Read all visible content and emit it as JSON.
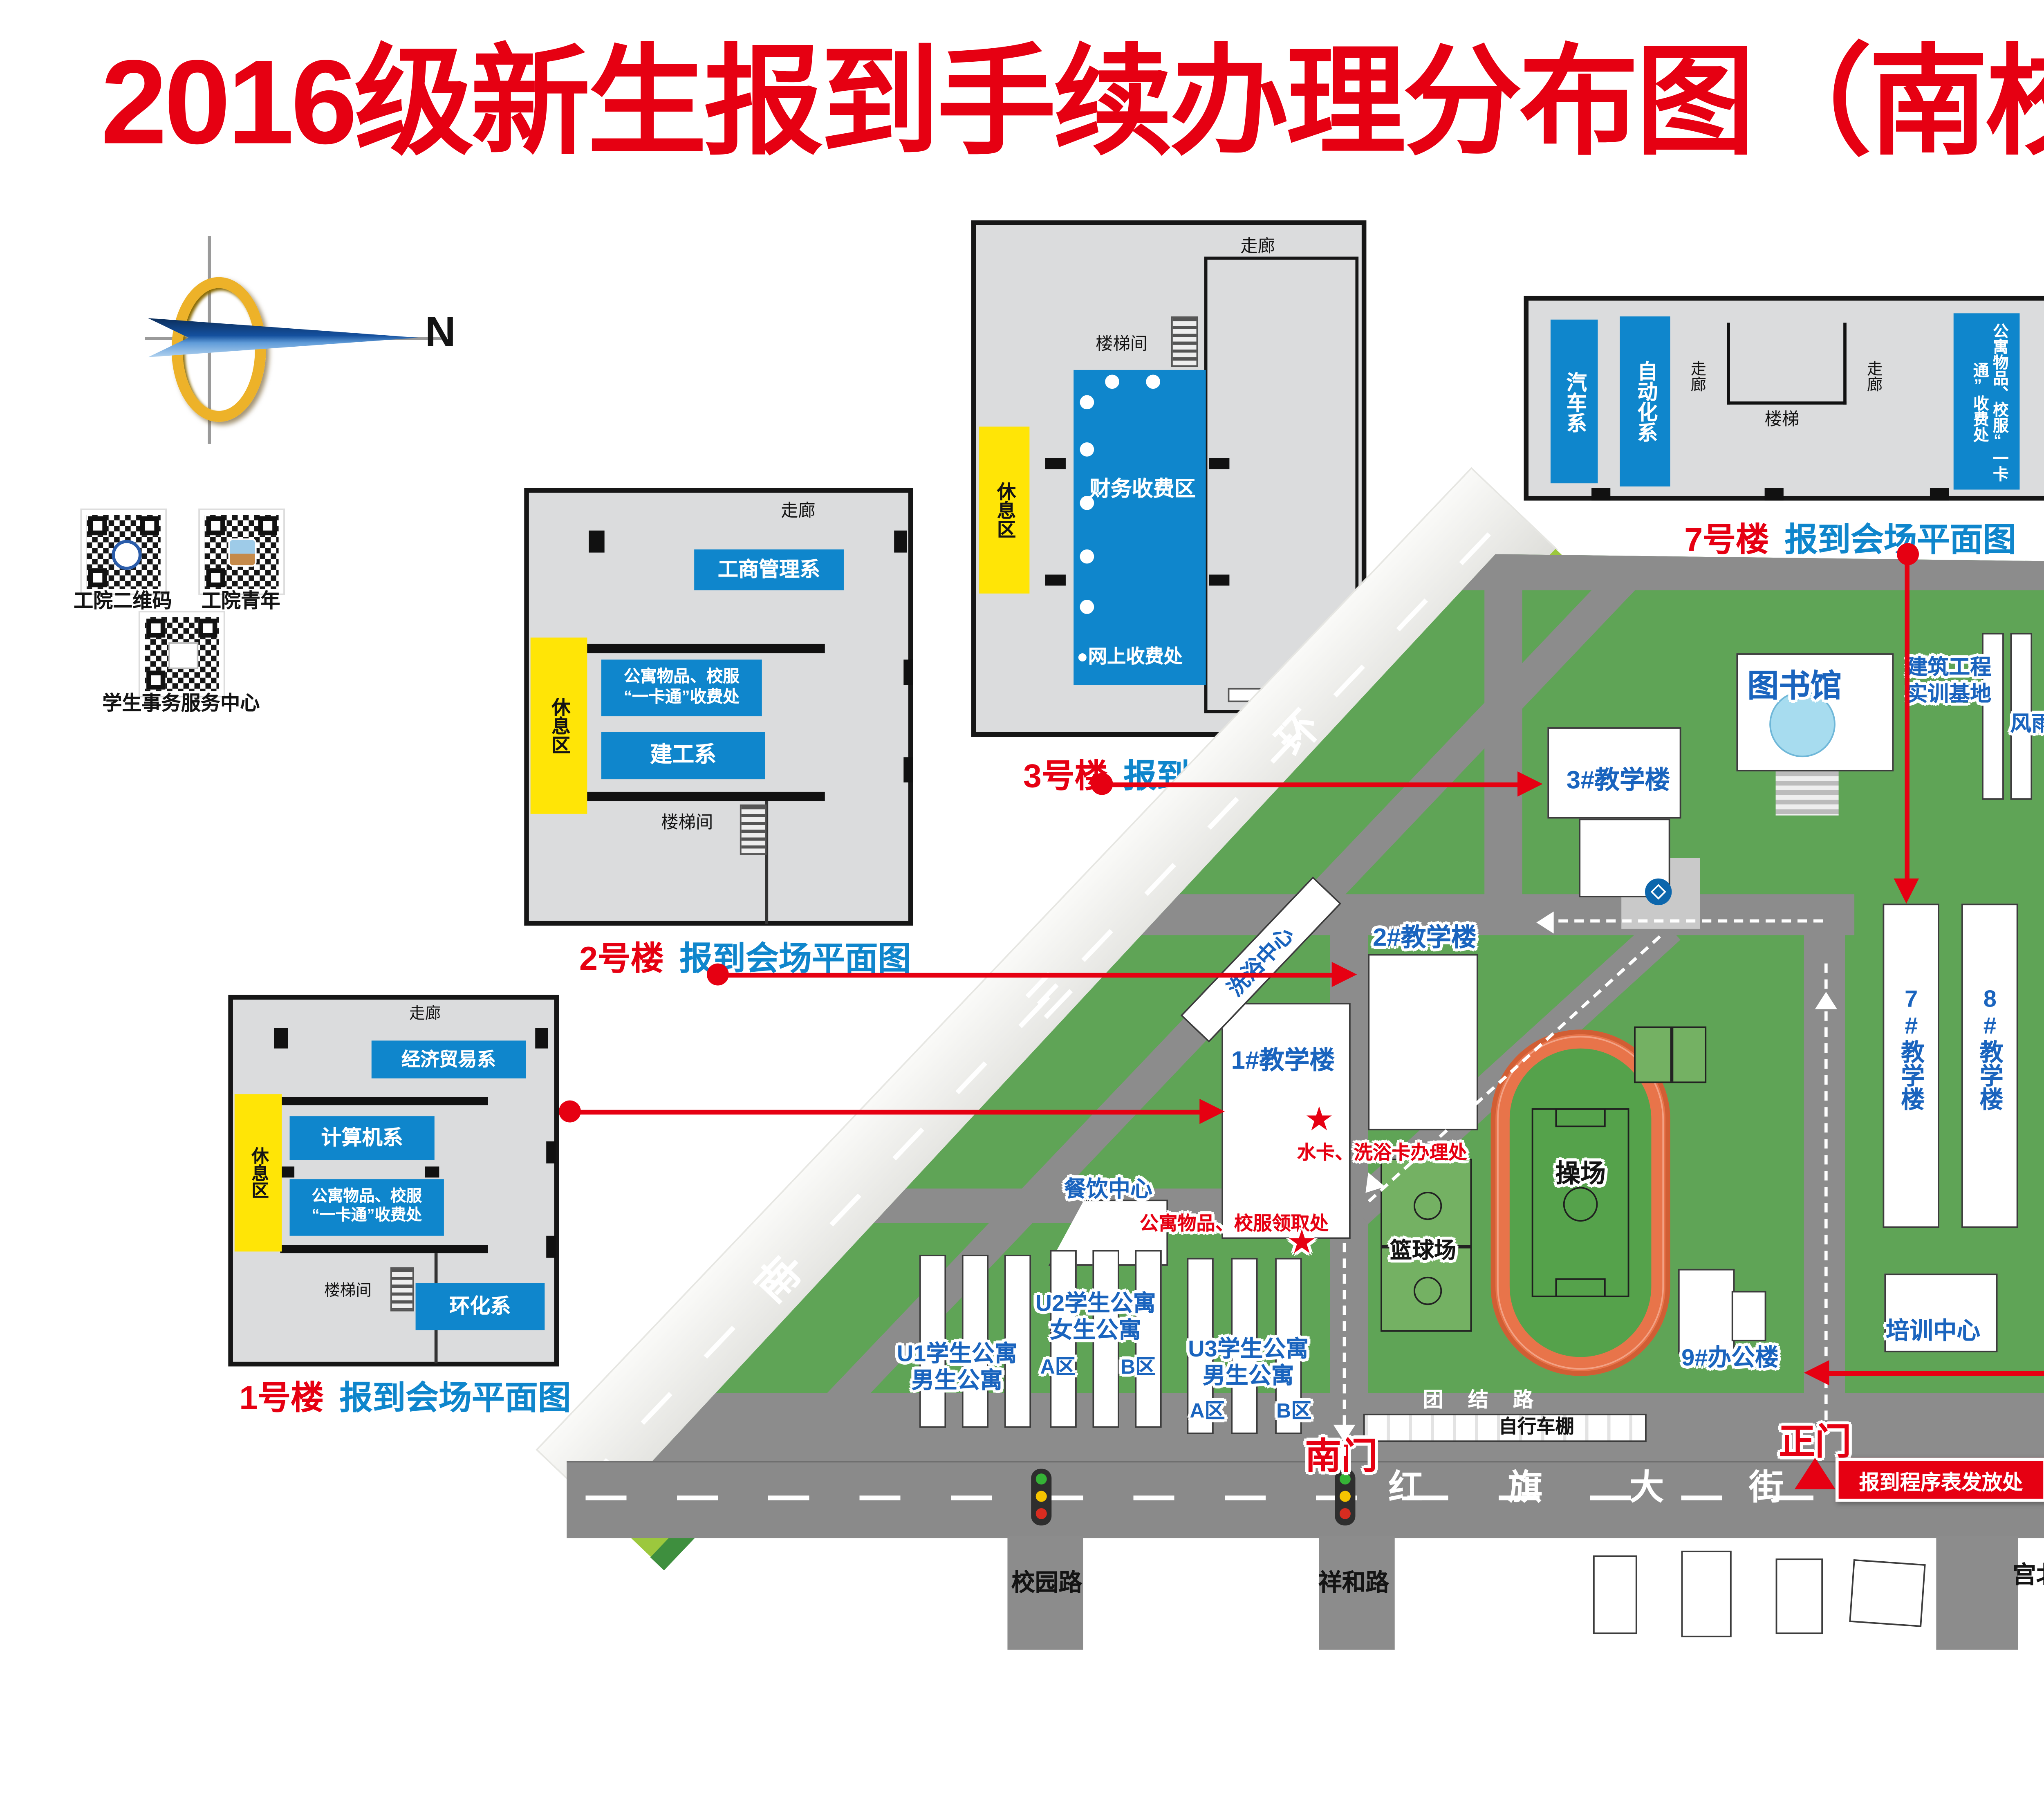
{
  "title": "2016级新生报到手续办理分布图（南校区）",
  "compass": {
    "north": "N"
  },
  "qr": {
    "q1": "工院二维码",
    "q2": "工院青年",
    "q3": "学生事务服务中心"
  },
  "plans": {
    "common": {
      "corridor": "走廊",
      "stair_room": "楼梯间",
      "stair": "楼梯",
      "rest": "休息区",
      "caption": "报到会场平面图"
    },
    "b1": {
      "no": "1号楼",
      "r1": "经济贸易系",
      "r2": "计算机系",
      "r3a": "公寓物品、校服",
      "r3b": "“一卡通”收费处",
      "r4": "环化系"
    },
    "b2": {
      "no": "2号楼",
      "r1": "工商管理系",
      "r2a": "公寓物品、校服",
      "r2b": "“一卡通”收费处",
      "r3": "建工系"
    },
    "b3": {
      "no": "3号楼",
      "r1": "财务收费区",
      "r2": "●网上收费处"
    },
    "b7": {
      "no": "7号楼",
      "r1": "汽车系",
      "r2": "自动化系",
      "r3": "公寓物品、校服“一卡通”收费处",
      "r4": "材料系"
    }
  },
  "map": {
    "ring": {
      "c1": "南",
      "c2": "三",
      "c3": "环"
    },
    "street": {
      "c1": "红",
      "c2": "旗",
      "c3": "大",
      "c4": "街"
    },
    "roads": {
      "tuanjie": "团 结 路",
      "xiaoyuan": "校园路",
      "xianghe": "祥和路",
      "gongbei": "宫北路"
    },
    "gates": {
      "south": "南门",
      "main": "正门"
    },
    "bld": {
      "library": "图书馆",
      "jz1": "建筑工程",
      "jz2": "实训基地",
      "fengyu": "风雨操场",
      "t3": "3#教学楼",
      "t2": "2#教学楼",
      "t1": "1#教学楼",
      "bath": "洗浴中心",
      "dining": "餐饮中心",
      "t7": "7#教学楼",
      "t8": "8#教学楼",
      "office9": "9#办公楼",
      "training": "培训中心",
      "playground": "操场",
      "basketball": "篮球场",
      "bikeshed": "自行车棚",
      "u1a": "U1学生公寓",
      "u1b": "男生公寓",
      "u2a": "U2学生公寓",
      "u2b": "女生公寓",
      "u3a": "U3学生公寓",
      "u3b": "男生公寓",
      "a1": "A区",
      "b1": "B区",
      "a2": "A区",
      "b2": "B区"
    },
    "poi": {
      "star": "★",
      "water": "水卡、洗浴卡办理处",
      "pickup": "公寓物品、校服领取处",
      "handout": "报到程序表发放处"
    }
  },
  "info": {
    "l1a": "生源地贷款",
    "l1b": "咨询处",
    "l1c": "新生入伍",
    "l1d": "咨询处",
    "n1": "（一楼北楼111室）",
    "l2": "总咨询台一",
    "n2": "（一楼北楼105室）",
    "l3a": "总咨询台二",
    "l3b": "（招生咨询）",
    "n3": "（一楼南楼106室）",
    "phone": "电话：85239777"
  }
}
